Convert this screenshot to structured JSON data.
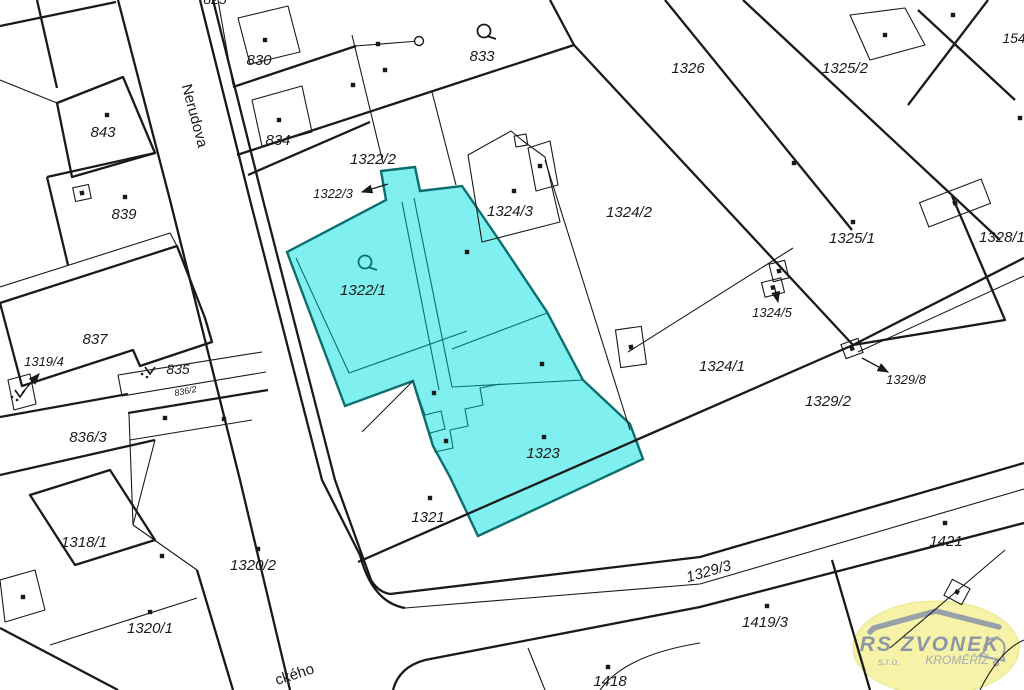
{
  "map": {
    "title": "Cadastral map with highlighted parcels 1322/1 and 1323",
    "colors": {
      "background": "#FFFFFF",
      "boundary_line": "#1A1A1A",
      "highlight_fill": "#7FEFEF",
      "highlight_edge": "#0E6E6E",
      "highlight_text": "#2A9C9C"
    },
    "street_labels": [
      {
        "text": "Nerudova",
        "x": 190,
        "y": 117,
        "rot": 75,
        "size": 15
      },
      {
        "text": "ckého",
        "x": 296,
        "y": 679,
        "rot": -18,
        "size": 15
      }
    ],
    "parcel_labels": [
      {
        "text": "825",
        "x": 215,
        "y": 4,
        "size": 14
      },
      {
        "text": "830",
        "x": 259,
        "y": 65,
        "size": 15
      },
      {
        "text": "833",
        "x": 482,
        "y": 61,
        "size": 15
      },
      {
        "text": "1326",
        "x": 688,
        "y": 73,
        "size": 15
      },
      {
        "text": "1325/2",
        "x": 845,
        "y": 73,
        "size": 15
      },
      {
        "text": "154",
        "x": 1014,
        "y": 43,
        "size": 14
      },
      {
        "text": "843",
        "x": 103,
        "y": 137,
        "size": 15
      },
      {
        "text": "834",
        "x": 278,
        "y": 145,
        "size": 15
      },
      {
        "text": "1322/2",
        "x": 373,
        "y": 164,
        "size": 15
      },
      {
        "text": "1322/3",
        "x": 333,
        "y": 198,
        "size": 13
      },
      {
        "text": "839",
        "x": 124,
        "y": 219,
        "size": 15
      },
      {
        "text": "1324/3",
        "x": 510,
        "y": 216,
        "size": 15
      },
      {
        "text": "1324/2",
        "x": 629,
        "y": 217,
        "size": 15
      },
      {
        "text": "1325/1",
        "x": 852,
        "y": 243,
        "size": 15
      },
      {
        "text": "1328/1",
        "x": 1002,
        "y": 242,
        "size": 15
      },
      {
        "text": "1322/1",
        "x": 363,
        "y": 295,
        "size": 15,
        "color": "#2A9C9C"
      },
      {
        "text": "1324/5",
        "x": 772,
        "y": 317,
        "size": 13
      },
      {
        "text": "837",
        "x": 95,
        "y": 344,
        "size": 15
      },
      {
        "text": "1319/4",
        "x": 44,
        "y": 366,
        "size": 13
      },
      {
        "text": "835",
        "x": 178,
        "y": 374,
        "size": 14
      },
      {
        "text": "836/2",
        "x": 186,
        "y": 394,
        "size": 9,
        "rot": -11
      },
      {
        "text": "1324/1",
        "x": 722,
        "y": 371,
        "size": 15
      },
      {
        "text": "1329/8",
        "x": 906,
        "y": 384,
        "size": 13
      },
      {
        "text": "1329/2",
        "x": 828,
        "y": 406,
        "size": 15
      },
      {
        "text": "836/3",
        "x": 88,
        "y": 442,
        "size": 15
      },
      {
        "text": "1323",
        "x": 543,
        "y": 458,
        "size": 15,
        "color": "#2A9C9C"
      },
      {
        "text": "1321",
        "x": 428,
        "y": 522,
        "size": 15
      },
      {
        "text": "1318/1",
        "x": 84,
        "y": 547,
        "size": 15
      },
      {
        "text": "1320/2",
        "x": 253,
        "y": 570,
        "size": 15
      },
      {
        "text": "1329/3",
        "x": 710,
        "y": 576,
        "size": 15,
        "rot": -16
      },
      {
        "text": "1421",
        "x": 946,
        "y": 546,
        "size": 15
      },
      {
        "text": "1419/3",
        "x": 765,
        "y": 627,
        "size": 15
      },
      {
        "text": "1320/1",
        "x": 150,
        "y": 633,
        "size": 15
      },
      {
        "text": "1418",
        "x": 610,
        "y": 686,
        "size": 15
      }
    ],
    "symbols": {
      "building_dots": [
        [
          107,
          115
        ],
        [
          265,
          40
        ],
        [
          279,
          120
        ],
        [
          125,
          197
        ],
        [
          378,
          44
        ],
        [
          385,
          70
        ],
        [
          353,
          85
        ],
        [
          514,
          191
        ],
        [
          540,
          166
        ],
        [
          885,
          35
        ],
        [
          953,
          15
        ],
        [
          1020,
          118
        ],
        [
          794,
          163
        ],
        [
          853,
          222
        ],
        [
          467,
          252
        ],
        [
          542,
          364
        ],
        [
          434,
          393
        ],
        [
          446,
          441
        ],
        [
          544,
          437
        ],
        [
          430,
          498
        ],
        [
          162,
          556
        ],
        [
          258,
          549
        ],
        [
          150,
          612
        ],
        [
          23,
          597
        ],
        [
          945,
          523
        ],
        [
          767,
          606
        ],
        [
          608,
          667
        ],
        [
          165,
          418
        ],
        [
          224,
          419
        ]
      ],
      "outlined_squares": [
        {
          "x": 74,
          "y": 186,
          "w": 16,
          "h": 14,
          "rot": -12,
          "dot": true
        },
        {
          "x": 843,
          "y": 341,
          "w": 18,
          "h": 15,
          "rot": -20,
          "dot": true
        },
        {
          "x": 618,
          "y": 328,
          "w": 26,
          "h": 38,
          "rot": -8,
          "dot": true
        },
        {
          "x": 763,
          "y": 280,
          "w": 20,
          "h": 15,
          "rot": -14,
          "dot": true
        },
        {
          "x": 771,
          "y": 262,
          "w": 16,
          "h": 18,
          "rot": -14,
          "dot": true
        },
        {
          "x": 947,
          "y": 583,
          "w": 20,
          "h": 18,
          "rot": 28,
          "dot": true
        },
        {
          "x": 922,
          "y": 190,
          "w": 66,
          "h": 26,
          "rot": -21,
          "dot": true
        },
        {
          "x": 515,
          "y": 135,
          "w": 12,
          "h": 11,
          "rot": -10,
          "dot": false
        }
      ],
      "wells": [
        [
          365,
          262
        ],
        [
          484,
          31
        ]
      ],
      "boundary_circles": [
        [
          419,
          41
        ]
      ],
      "v_marks": [
        [
          150,
          371
        ],
        [
          20,
          394
        ]
      ],
      "arrows": [
        {
          "x1": 388,
          "y1": 184,
          "x2": 362,
          "y2": 192
        },
        {
          "x1": 22,
          "y1": 393,
          "x2": 39,
          "y2": 374
        },
        {
          "x1": 775,
          "y1": 289,
          "x2": 778,
          "y2": 302
        },
        {
          "x1": 862,
          "y1": 358,
          "x2": 888,
          "y2": 372
        }
      ]
    }
  },
  "logo": {
    "company": "RS ZVONEK",
    "suffix": "s.r.o.",
    "city": "KROMĚŘÍŽ",
    "colors": {
      "ellipse_fill": "#F6F3A8",
      "ellipse_edge": "#E9E387",
      "roof_gray": "#98A0AA",
      "text_gray": "#8E96A4",
      "small_text_gray": "#A5ABB5"
    }
  }
}
